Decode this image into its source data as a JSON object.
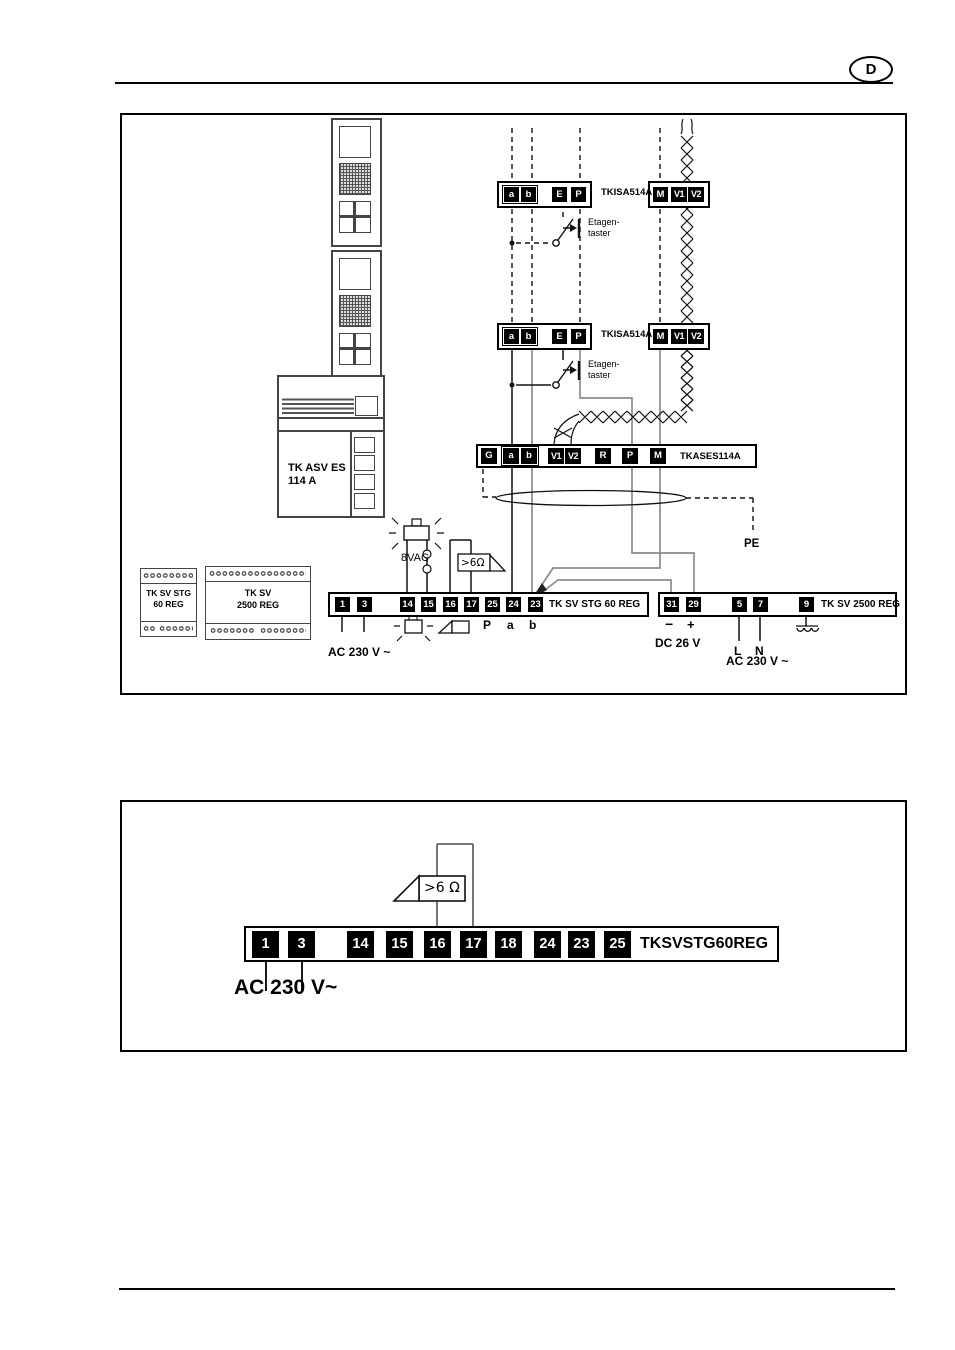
{
  "page": {
    "badge": "D"
  },
  "d1": {
    "tkisa": {
      "terms": [
        "a",
        "b",
        "E",
        "P"
      ],
      "label": "TKISA514A",
      "mterms": [
        "M",
        "V1",
        "V2"
      ]
    },
    "taster": {
      "line1": "Etagen-",
      "line2": "taster"
    },
    "tkases": {
      "terms": [
        "G",
        "a",
        "b",
        "V1",
        "V2",
        "R",
        "P",
        "M"
      ],
      "label": "TKASES114A"
    },
    "pe": "PE",
    "bell_voltage": "8VAC",
    "speaker_impedance": ">6Ω",
    "asv": {
      "line1": "TK ASV ES",
      "line2": "114 A"
    },
    "regA": {
      "line1": "TK SV STG",
      "line2": "60 REG"
    },
    "regB": {
      "line1": "TK SV",
      "line2": "2500 REG"
    },
    "strip1": {
      "terms": [
        "1",
        "3",
        "14",
        "15",
        "16",
        "17",
        "25",
        "24",
        "23"
      ],
      "label": "TK SV STG 60 REG",
      "sub": {
        "p": "P",
        "a": "a",
        "b": "b"
      },
      "ac": "AC 230 V ~"
    },
    "strip2": {
      "terms": [
        "31",
        "29",
        "5",
        "7",
        "9"
      ],
      "label": "TK SV 2500 REG",
      "minus": "−",
      "plus": "+",
      "dc": "DC 26 V",
      "l": "L",
      "n": "N",
      "ac": "AC 230 V ~"
    }
  },
  "d2": {
    "strip": {
      "terms": [
        "1",
        "3",
        "14",
        "15",
        "16",
        "17",
        "18",
        "24",
        "23",
        "25"
      ],
      "label": "TKSVSTG60REG"
    },
    "speaker_impedance": ">6 Ω",
    "ac": "AC 230 V~"
  }
}
